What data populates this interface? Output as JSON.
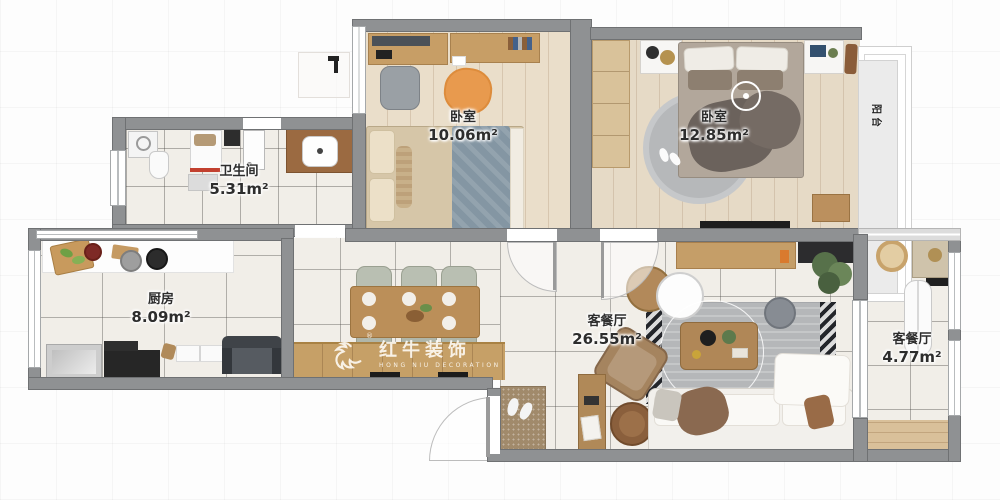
{
  "watermark": {
    "brand": "红牛装饰",
    "reg": "®",
    "subtitle": "HONG NIU DECORATION"
  },
  "rooms": {
    "bedroom1": {
      "name": "卧室",
      "area": "10.06m²"
    },
    "bedroom2": {
      "name": "卧室",
      "area": "12.85m²"
    },
    "bathroom": {
      "name": "卫生间",
      "area": "5.31m²"
    },
    "kitchen": {
      "name": "厨房",
      "area": "8.09m²"
    },
    "living": {
      "name": "客餐厅",
      "area": "26.55m²"
    },
    "side": {
      "name": "客餐厅",
      "area": "4.77m²"
    },
    "balcony": {
      "name": "阳台"
    }
  },
  "colors": {
    "wall": "#8f9193",
    "tile": "#f1eee8",
    "woodFloor": "#eadeca",
    "woodFurniture": "#c59e68",
    "accentOrange": "#e89a4e",
    "watermarkText": "#ffffff"
  }
}
